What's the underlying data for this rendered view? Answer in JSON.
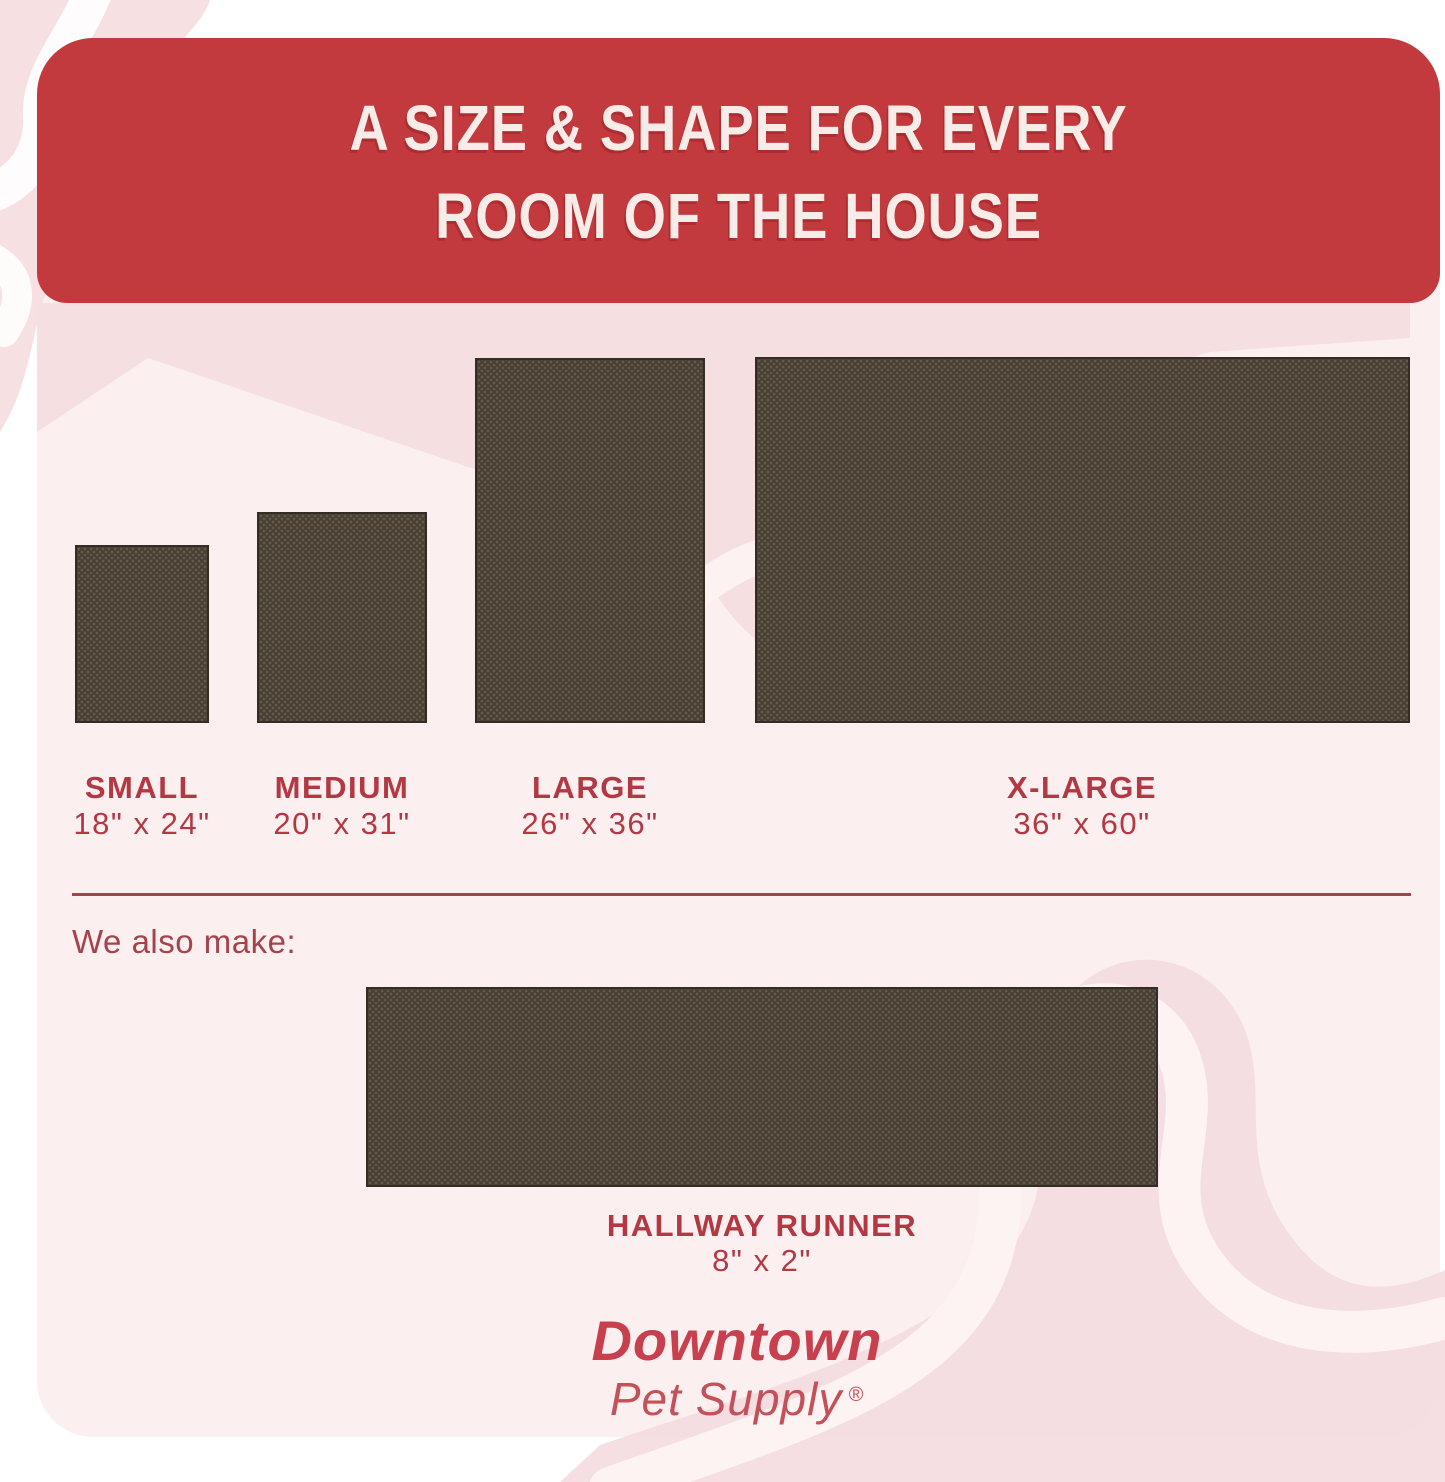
{
  "header": {
    "line1": "A SIZE & SHAPE FOR EVERY",
    "line2": "ROOM OF THE HOUSE"
  },
  "sizes": [
    {
      "id": "small",
      "name": "SMALL",
      "dimensions": "18\" x 24\""
    },
    {
      "id": "medium",
      "name": "MEDIUM",
      "dimensions": "20\" x 31\""
    },
    {
      "id": "large",
      "name": "LARGE",
      "dimensions": "26\" x 36\""
    },
    {
      "id": "xlarge",
      "name": "X-LARGE",
      "dimensions": "36\" x 60\""
    }
  ],
  "also_make": {
    "label": "We also make:",
    "product": {
      "name": "HALLWAY RUNNER",
      "dimensions": "8\" x 2\""
    }
  },
  "brand": {
    "name": "Downtown",
    "tagline": "Pet Supply",
    "registered": "®"
  },
  "colors": {
    "banner_red": "#C23A3E",
    "heading_text": "#F7ECE8",
    "label_red": "#B23944",
    "divider_red": "#9F444B",
    "also_make_red": "#A4434C",
    "logo_red": "#C8404D",
    "rug_brown": "#463E33",
    "card_pink": "#FBF0EF",
    "accent_pink": "#F5DFE1",
    "page_white": "#FFFFFF"
  }
}
